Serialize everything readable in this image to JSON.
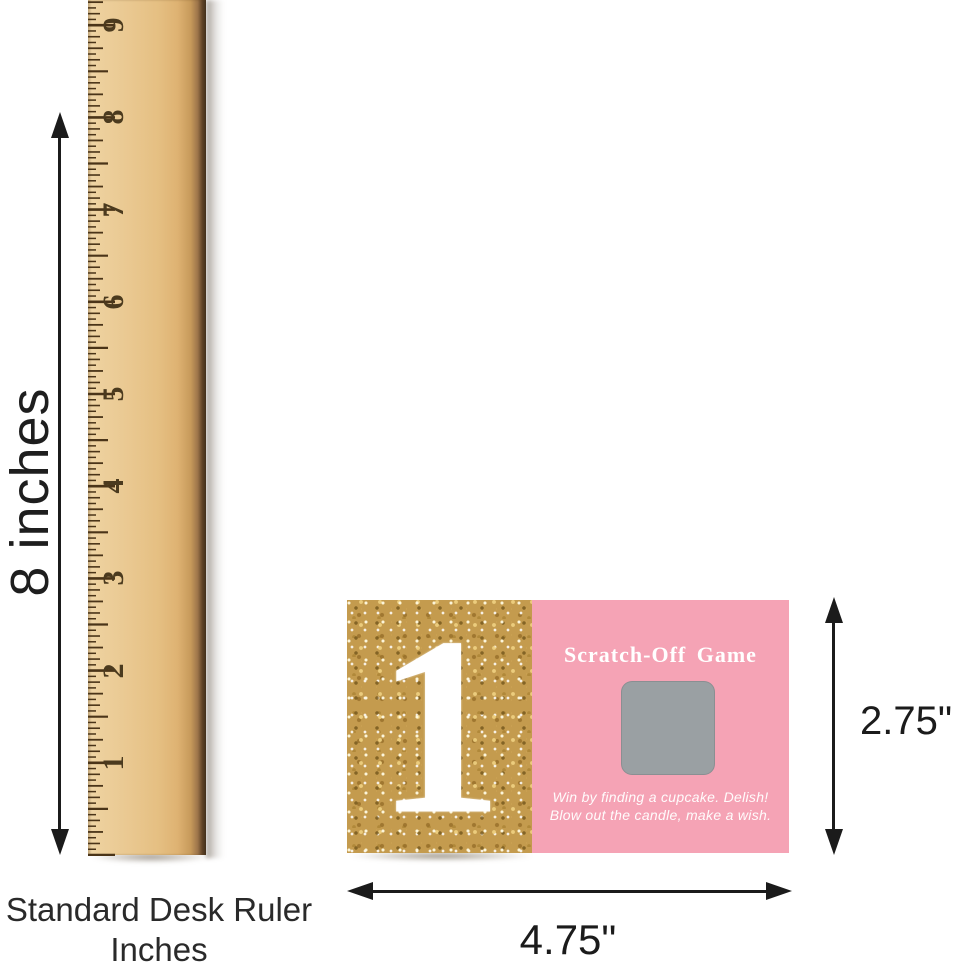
{
  "ruler": {
    "numbers": [
      "1",
      "2",
      "3",
      "4",
      "5",
      "6",
      "7",
      "8",
      "9"
    ],
    "caption_line1": "Standard Desk Ruler",
    "caption_line2": "Inches",
    "wood_color": "#e9c78f",
    "tick_color": "#4a3418",
    "number_color": "#4b3a1e"
  },
  "annotations": {
    "ruler_height_label": "8 inches",
    "card_height_label": "2.75\"",
    "card_width_label": "4.75\"",
    "arrow_color": "#1b1b1b"
  },
  "card": {
    "big_number": "1",
    "title": "Scratch-Off Game",
    "line1": "Win by finding a cupcake. Delish!",
    "line2": "Blow out the candle, make a wish.",
    "pink_color": "#f5a3b5",
    "gold_color": "#c49b4e",
    "scratch_square_color": "#9aa0a3",
    "text_color": "#ffffff"
  }
}
